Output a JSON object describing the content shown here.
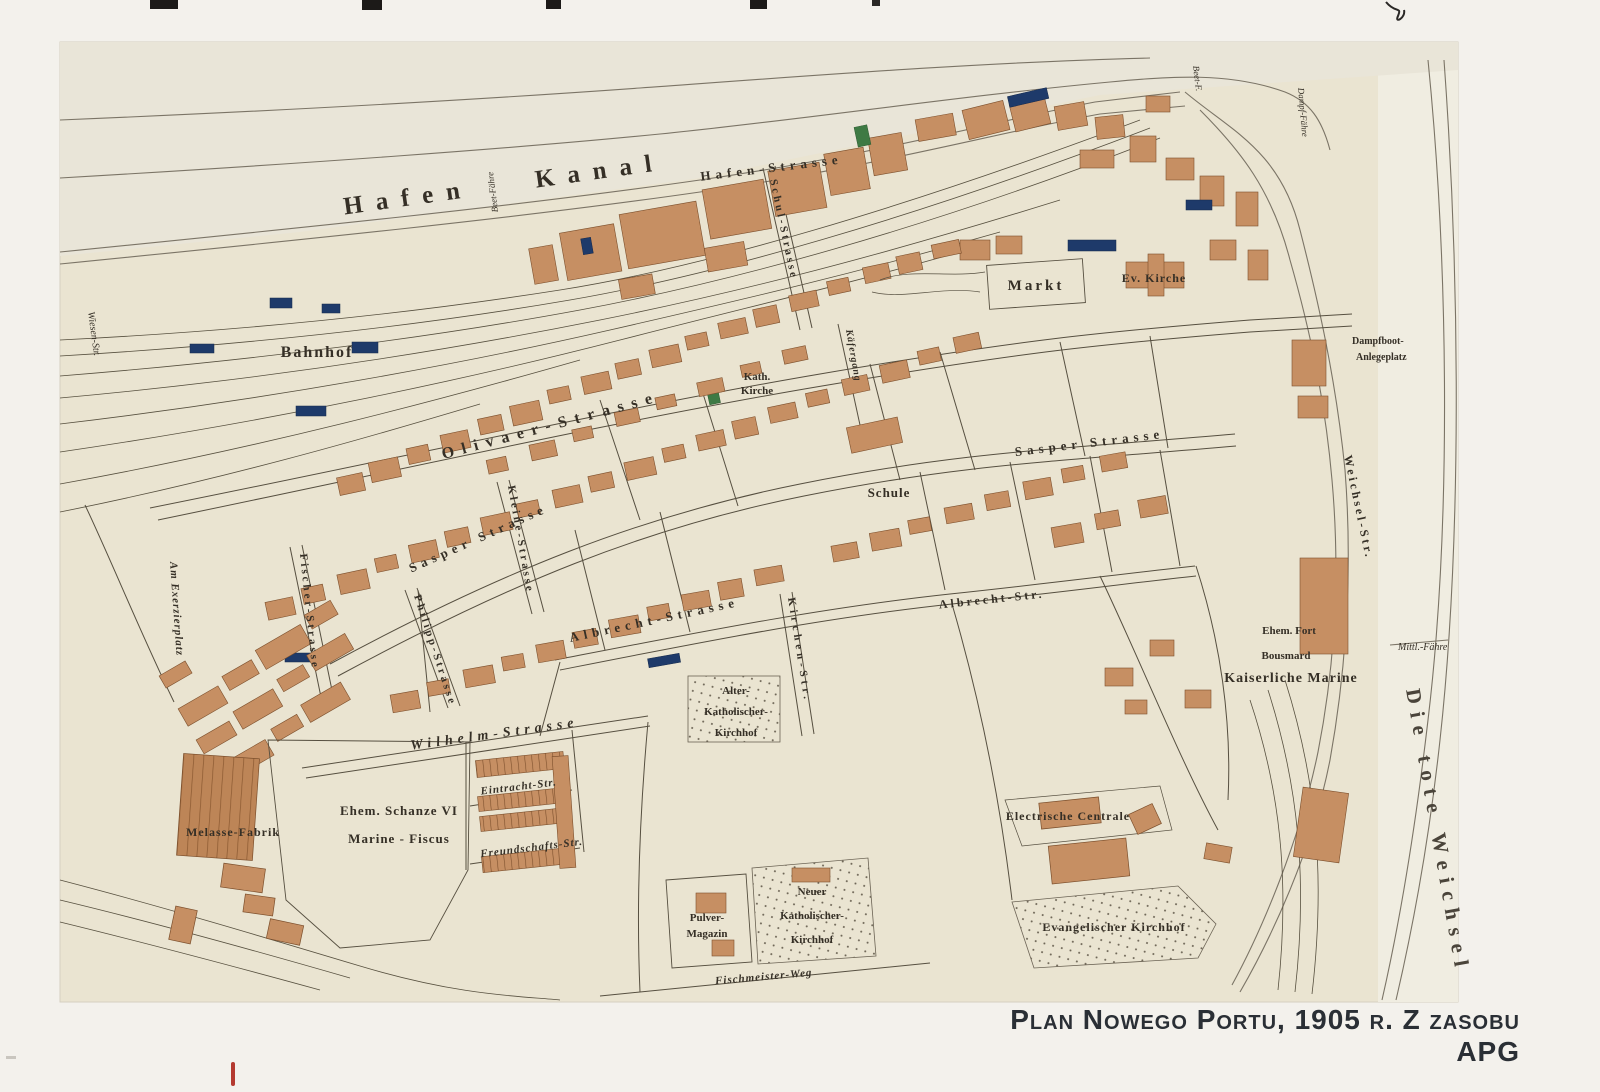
{
  "caption": "Plan Nowego Portu, 1905 r. Z zasobu APG",
  "palette": {
    "paper": "#eae4d1",
    "paper_light": "#f0ede1",
    "ink": "#3c362c",
    "brick": "#c68f63",
    "brick_dark": "#7c4f2c",
    "navy": "#1e3a6a",
    "green": "#3e7a44",
    "red_mark": "#b43a30"
  },
  "labels": {
    "hafen_kanal": "Hafen Kanal",
    "beet_faehre": "Beet-Fähre",
    "beet_f": "Beet-F.",
    "dampf_faehre": "Dampf-Fähre",
    "dampfboot_1": "Dampfboot-",
    "dampfboot_2": "Anlegeplatz",
    "mittl_faehre": "Mittl.-Fähre",
    "die_tote_weichsel": "Die tote Weichsel",
    "bahnhof": "Bahnhof",
    "markt": "Markt",
    "ev_kirche": "Ev. Kirche",
    "kath_kirche_1": "Kath.",
    "kath_kirche_2": "Kirche",
    "schule": "Schule",
    "hafen_strasse": "Hafen-Strasse",
    "schul_strasse": "Schul-Strasse",
    "olivaer_strasse": "Olivaer-Strasse",
    "sasper_strasse_mid": "Sasper Strasse",
    "sasper_strasse_east": "Sasper Strasse",
    "kleine_strasse": "Kleine-Strasse",
    "kaefergang": "Käfergang",
    "kirchen_str": "Kirchen-Str.",
    "albrecht_strasse": "Albrecht-Strasse",
    "albrecht_str": "Albrecht-Str.",
    "fischer_strasse": "Fischer-Strasse",
    "philipp_strasse": "Philipp-Strasse",
    "am_exerzierplatz": "Am Exerzierplatz",
    "wilhelm_strasse": "Wilhelm-Strasse",
    "eintracht_str": "Eintracht-Str.",
    "freundschafts_str": "Freundschafts-Str.",
    "fischmeister_weg": "Fischmeister-Weg",
    "wiesen_str": "Wiesen-Str.",
    "weichsel_str": "Weichsel-Str.",
    "melasse_fabrik": "Melasse-Fabrik",
    "ehem_schanze": "Ehem. Schanze VI",
    "marine_fiscus": "Marine - Fiscus",
    "pulver_1": "Pulver-",
    "pulver_2": "Magazin",
    "neuer_kath_1": "Neuer",
    "neuer_kath_2": "Katholischer-",
    "neuer_kath_3": "Kirchhof",
    "alter_kath_1": "Alter-",
    "alter_kath_2": "Katholischer-",
    "alter_kath_3": "Kirchhof",
    "evangelischer_kirchhof": "Evangelischer Kirchhof",
    "electrische_centrale": "Electrische Centrale",
    "ehem_fort_1": "Ehem. Fort",
    "ehem_fort_2": "Bousmard",
    "kaiserliche_marine": "Kaiserliche Marine"
  }
}
